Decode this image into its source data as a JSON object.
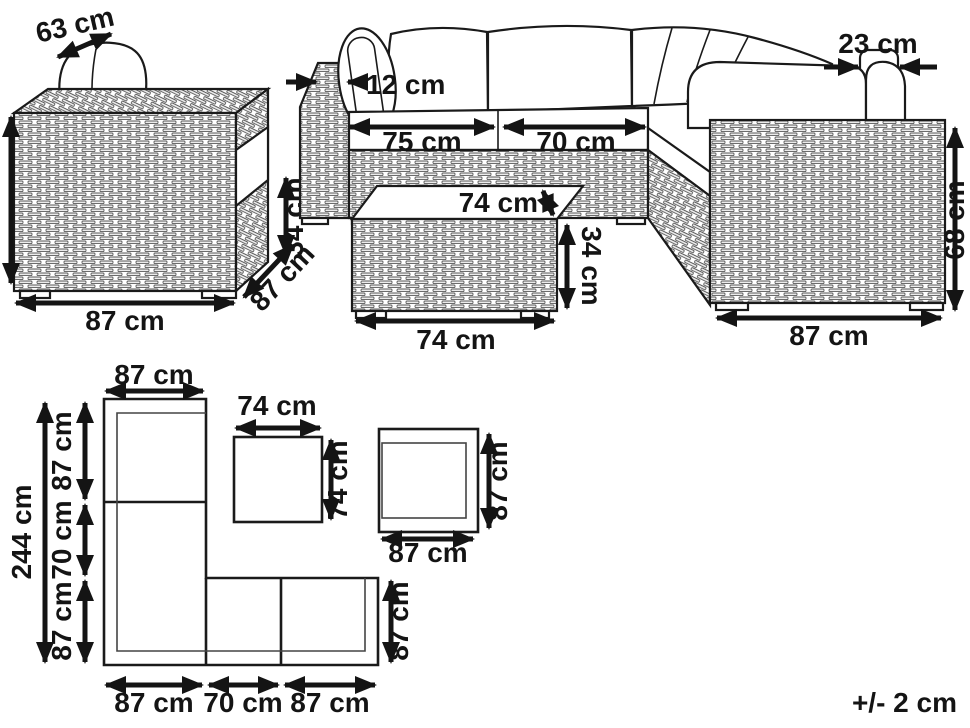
{
  "armchair": {
    "back_width": "63 cm",
    "width": "87 cm",
    "depth": "87 cm",
    "seat_height": "34 cm"
  },
  "sofa": {
    "armrest_width": "12 cm",
    "seat_left": "75 cm",
    "seat_right": "70 cm",
    "armrest_top": "23 cm",
    "side_height": "68 cm",
    "end_width": "87 cm"
  },
  "table": {
    "top_depth": "74 cm",
    "height": "34 cm",
    "width": "74 cm"
  },
  "plan": {
    "top_width": "87 cm",
    "total_depth": "244 cm",
    "seg_top": "87 cm",
    "seg_mid": "70 cm",
    "seg_bottom": "87 cm",
    "table_width": "74 cm",
    "table_depth": "74 cm",
    "chair_depth": "87 cm",
    "chair_width": "87 cm",
    "bottom_left": "87 cm",
    "bottom_mid": "70 cm",
    "bottom_right": "87 cm",
    "row_depth": "87 cm"
  },
  "tolerance": "+/- 2 cm"
}
